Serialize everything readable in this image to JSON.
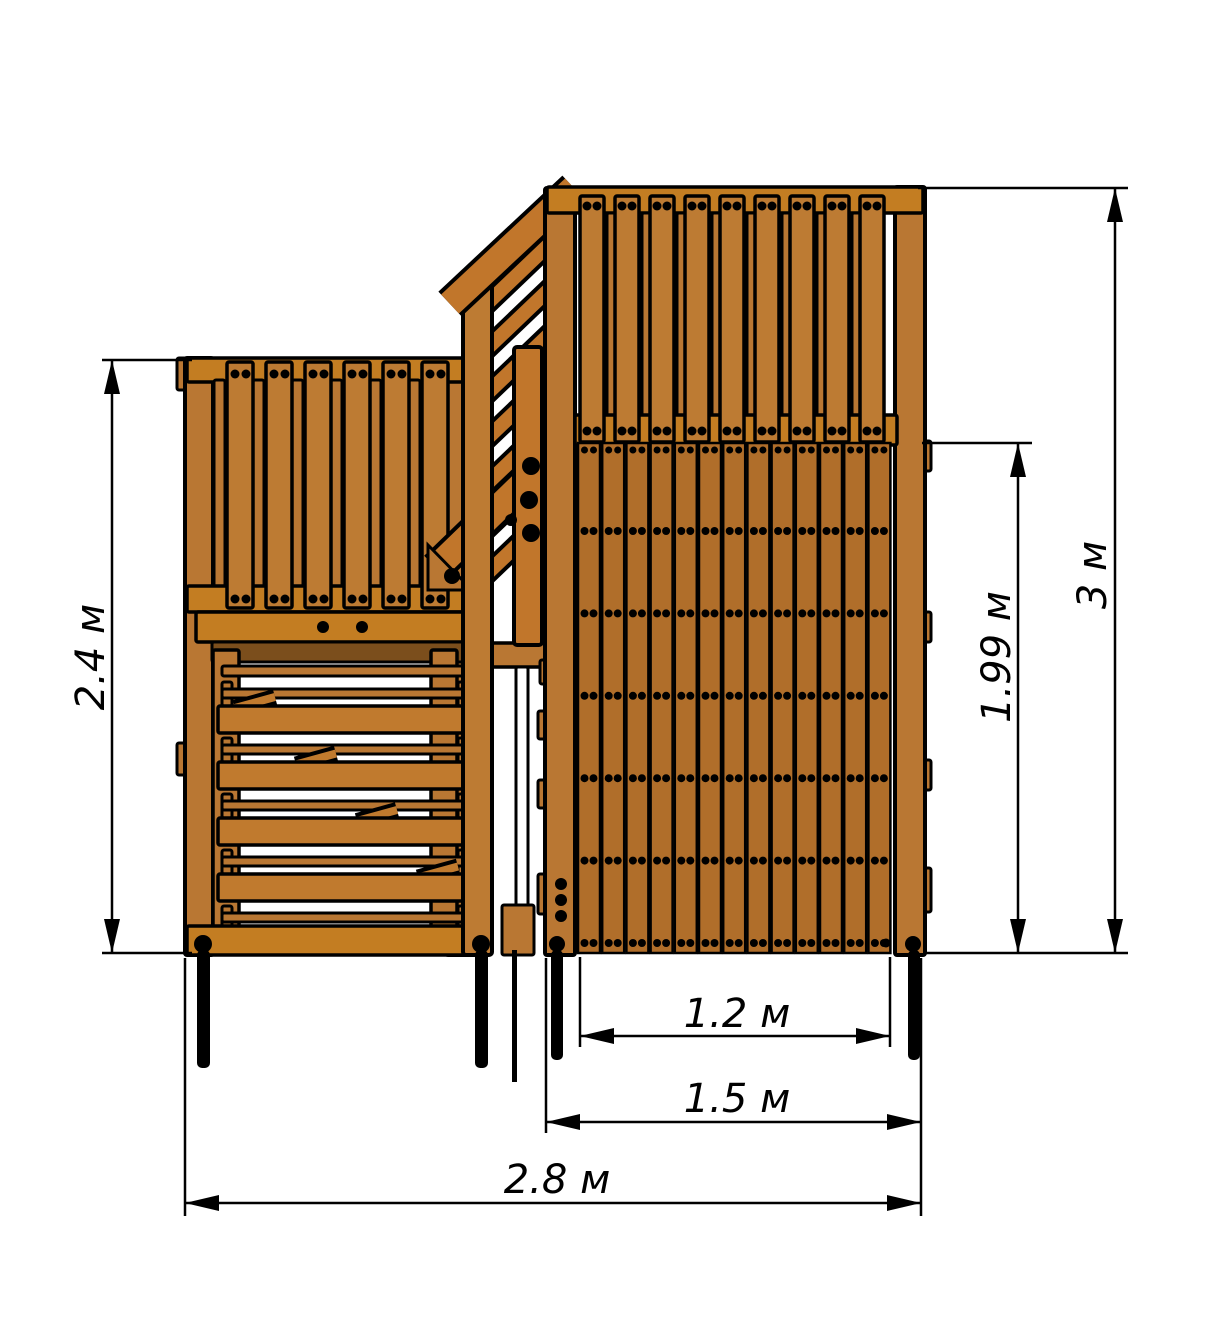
{
  "drawing": {
    "type": "front-elevation",
    "subject": "wooden playground twin tower with connecting stair"
  },
  "dimensions": {
    "left_tower_height": {
      "label": "2.4 м",
      "value": 2.4,
      "unit": "м"
    },
    "total_height": {
      "label": "3 м",
      "value": 3,
      "unit": "м"
    },
    "wall_panel_height": {
      "label": "1.99 м",
      "value": 1.99,
      "unit": "м"
    },
    "wall_inner_width": {
      "label": "1.2 м",
      "value": 1.2,
      "unit": "м"
    },
    "right_tower_width": {
      "label": "1.5 м",
      "value": 1.5,
      "unit": "м"
    },
    "total_width": {
      "label": "2.8 м",
      "value": 2.8,
      "unit": "м"
    }
  },
  "colors": {
    "background": "#FFFFFF",
    "outline": "#000000",
    "wood": "#B97733",
    "plank": "#B06E2A",
    "baluster": "#BD7B33",
    "band": "#C37D22",
    "rung": "#C07A2E",
    "stair": "#C1762B",
    "dark": "#7B4E1C"
  },
  "structure": {
    "left_balusters": 6,
    "left_narrow_slats": 6,
    "right_balusters": 9,
    "right_narrow_slats": 8,
    "wall_planks": 13,
    "wall_screw_rows": 6,
    "ladder_thin_rungs": 5,
    "ladder_thick_rungs": 4,
    "stair_slats": 7,
    "stair_tread_marks": 4
  }
}
